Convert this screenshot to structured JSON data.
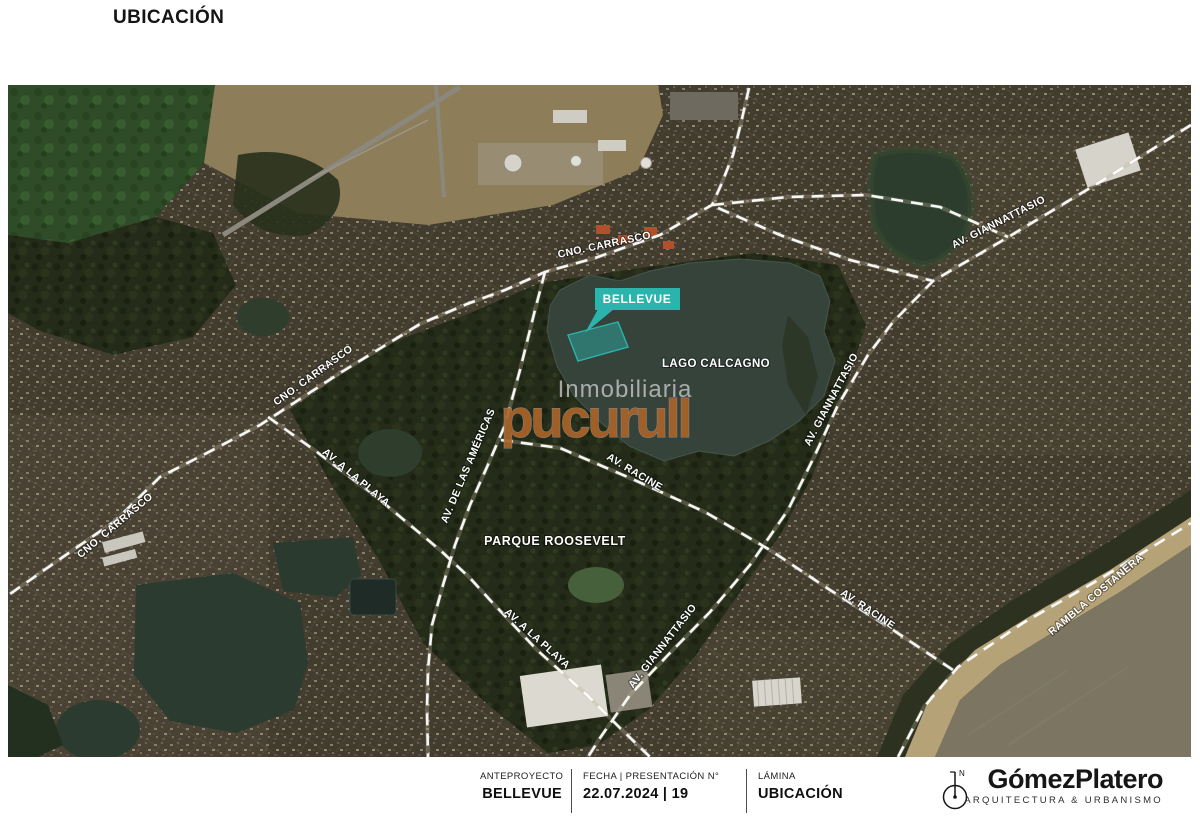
{
  "page": {
    "title": "UBICACIÓN"
  },
  "map": {
    "flag_label": "BELLEVUE",
    "lake_label": "LAGO CALCAGNO",
    "park_label": "PARQUE ROOSEVELT",
    "road_cno_carrasco": "CNO. CARRASCO",
    "road_giannattasio": "AV. GIANNATTASIO",
    "road_racine": "AV. RACINE",
    "road_americas": "AV. DE LAS AMÉRICAS",
    "road_a_la_playa": "AV. A LA PLAYA",
    "road_rambla": "RAMBLA COSTANERA",
    "watermark_text": "Inmobiliaria",
    "watermark_logo": "pucurull",
    "colors": {
      "site_accent": "#2ab4ac",
      "watermark_orange": "#a96328"
    }
  },
  "footer": {
    "project_label": "ANTEPROYECTO",
    "project_name": "BELLEVUE",
    "date_label": "FECHA | PRESENTACIÓN N°",
    "date_value": "22.07.2024 | 19",
    "sheet_label": "LÁMINA",
    "sheet_name": "UBICACIÓN",
    "north_letter": "N",
    "brand_name": "GómezPlatero",
    "brand_tagline": "ARQUITECTURA & URBANISMO"
  }
}
